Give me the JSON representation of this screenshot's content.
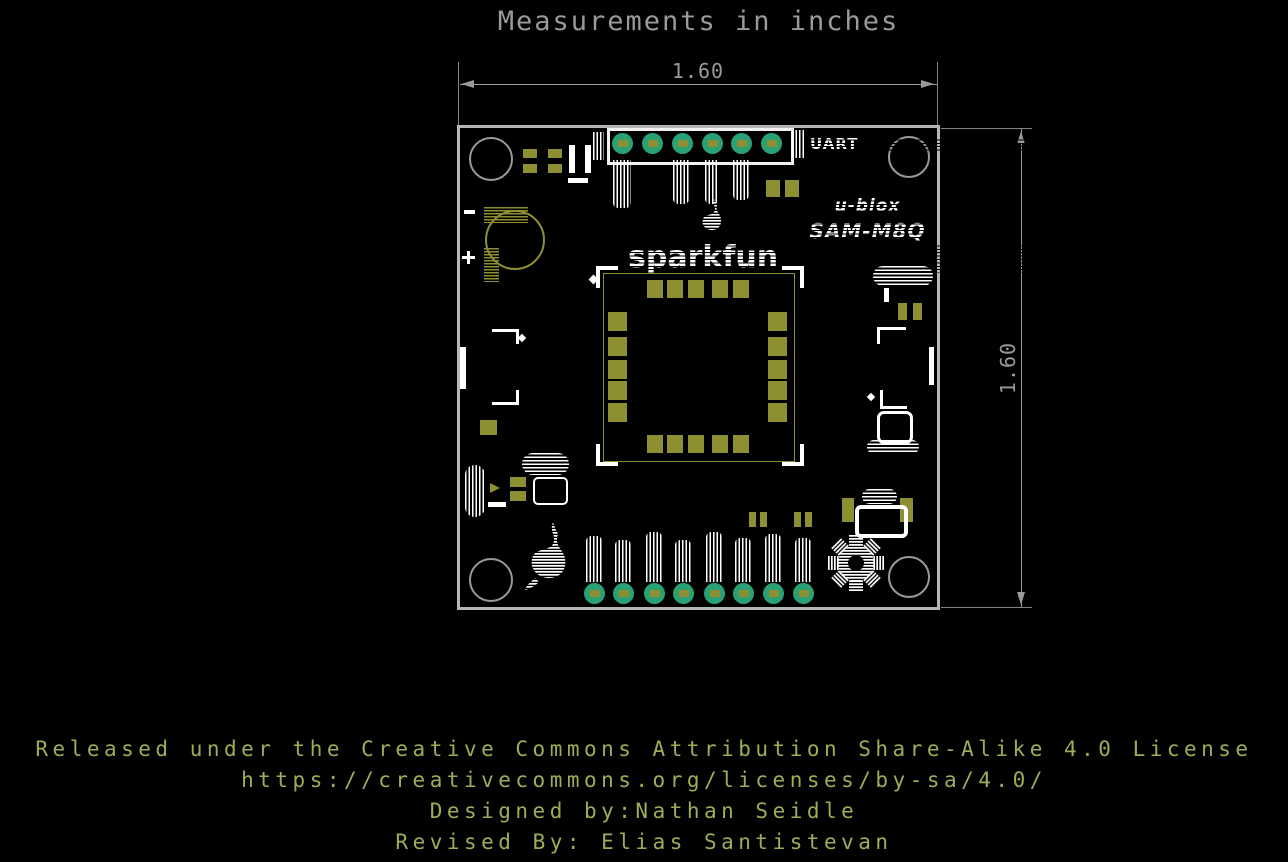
{
  "title": "Measurements in inches",
  "dimensions": {
    "width_inches": "1.60",
    "height_inches": "1.60"
  },
  "board": {
    "silkscreen": {
      "brand": "sparkfun",
      "module_brand": "u-blox",
      "module_model": "SAM-M8Q",
      "uart_label": "UART"
    }
  },
  "footer": {
    "lines": [
      "Released under the Creative Commons Attribution Share-Alike 4.0 License",
      "https://creativecommons.org/licenses/by-sa/4.0/",
      "Designed by:Nathan Seidle",
      "Revised By: Elias Santistevan"
    ]
  },
  "colors": {
    "background": "#000000",
    "board_outline": "#b5b5b5",
    "silkscreen_white": "#ffffff",
    "pad_gold": "#8e8e33",
    "pad_teal": "#2aa175",
    "dimension_gray": "#9a9a9a",
    "footer_text": "#a2aa58"
  }
}
